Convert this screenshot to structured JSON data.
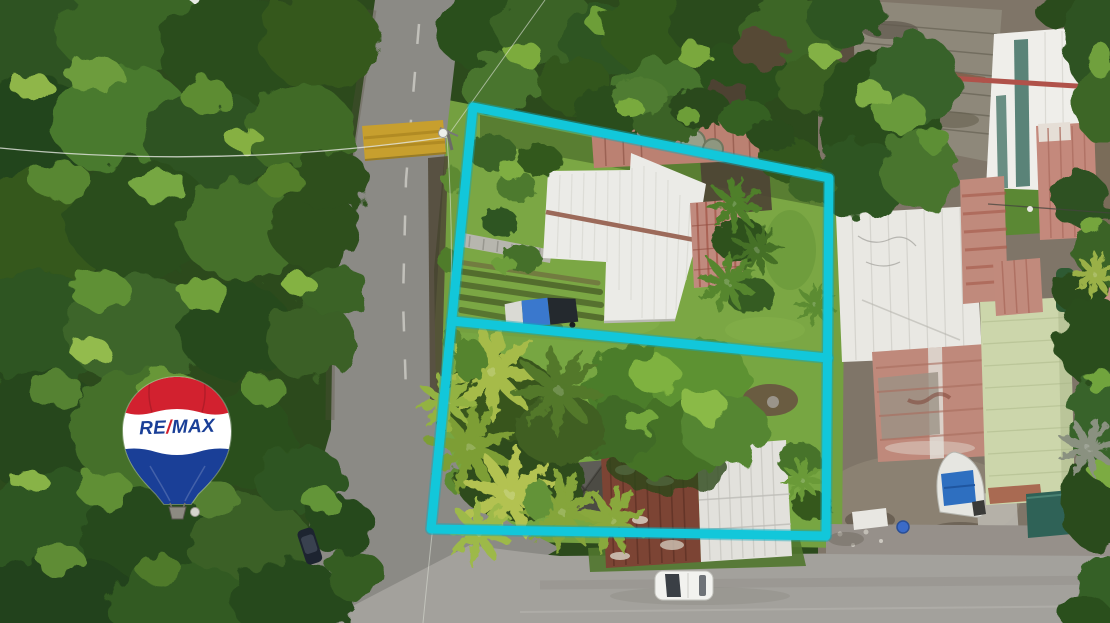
{
  "meta": {
    "description": "Aerial drone photograph of a rural property for sale: two adjacent land parcels outlined in cyan, dense forest and road on the left, neighboring metal-roof houses on the right, RE/MAX balloon watermark",
    "width_px": 1110,
    "height_px": 623
  },
  "brand": {
    "name": "RE/MAX",
    "balloon_text_left": "RE",
    "balloon_slash": "/",
    "balloon_text_right": "MAX",
    "red": "#D2212F",
    "blue": "#1A3F97",
    "white": "#FFFFFF"
  },
  "overlay": {
    "boundary_color": "#12C7DA",
    "parcel_count": 2,
    "parcels": [
      "upper-parcel-with-white-roof-house",
      "lower-parcel-with-palms-and-rust-roof-house"
    ]
  },
  "scene": {
    "roads": [
      "vertical-asphalt-road-left",
      "horizontal-gray-road-bottom"
    ],
    "road_features": [
      "yellow-speed-bump",
      "center-dashed-line",
      "utility-pole-with-lamp",
      "power-lines"
    ],
    "vehicles": [
      "white-car-on-bottom-road",
      "dark-parked-car-on-left-road"
    ],
    "landmarks": [
      "white-metal-roof-house",
      "pink-roof-section",
      "round-water-tanks",
      "boat-with-blue-tarp",
      "coconut-palm-grove",
      "rust-and-white-roof-house",
      "neighbor-weathered-gray-roof",
      "neighbor-white-roof-with-teal-stripes",
      "pale-green-roof",
      "teal-shed",
      "dense-forest-left",
      "white-building-top-left"
    ]
  }
}
